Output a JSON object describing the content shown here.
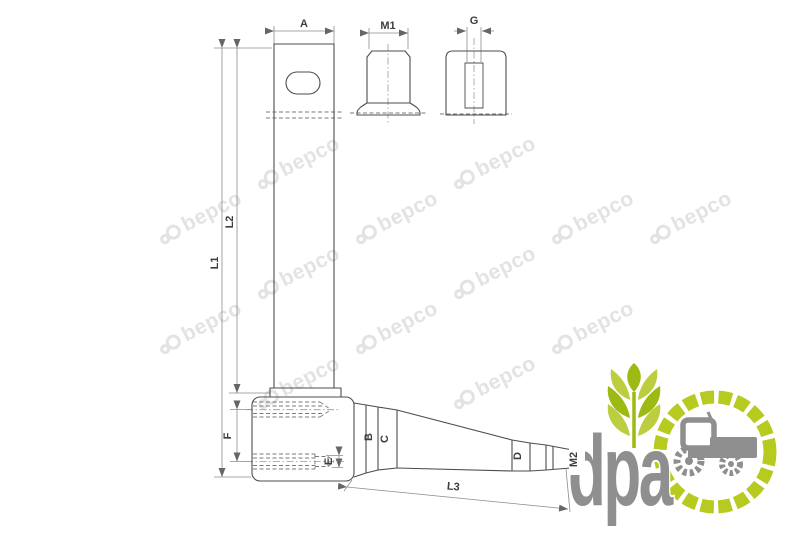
{
  "drawing": {
    "labels": {
      "a": "A",
      "m1": "M1",
      "g": "G",
      "l1": "L1",
      "l2": "L2",
      "l3": "L3",
      "f": "F",
      "e": "E",
      "b": "B",
      "c": "C",
      "d": "D",
      "m2": "M2"
    }
  },
  "watermark": {
    "text": "bepco",
    "color": "#e3e3e3",
    "positions": [
      {
        "x": 200,
        "y": 218
      },
      {
        "x": 200,
        "y": 328
      },
      {
        "x": 298,
        "y": 163
      },
      {
        "x": 298,
        "y": 273
      },
      {
        "x": 298,
        "y": 383
      },
      {
        "x": 396,
        "y": 218
      },
      {
        "x": 396,
        "y": 328
      },
      {
        "x": 494,
        "y": 163
      },
      {
        "x": 494,
        "y": 273
      },
      {
        "x": 494,
        "y": 383
      },
      {
        "x": 592,
        "y": 218
      },
      {
        "x": 592,
        "y": 328
      },
      {
        "x": 690,
        "y": 218
      }
    ]
  },
  "logo": {
    "text": "dpa",
    "text_color": "#8f8f8f",
    "ring_color": "#b7ca20",
    "wheat_color_dark": "#9db913",
    "wheat_color_light": "#bccd3f"
  }
}
